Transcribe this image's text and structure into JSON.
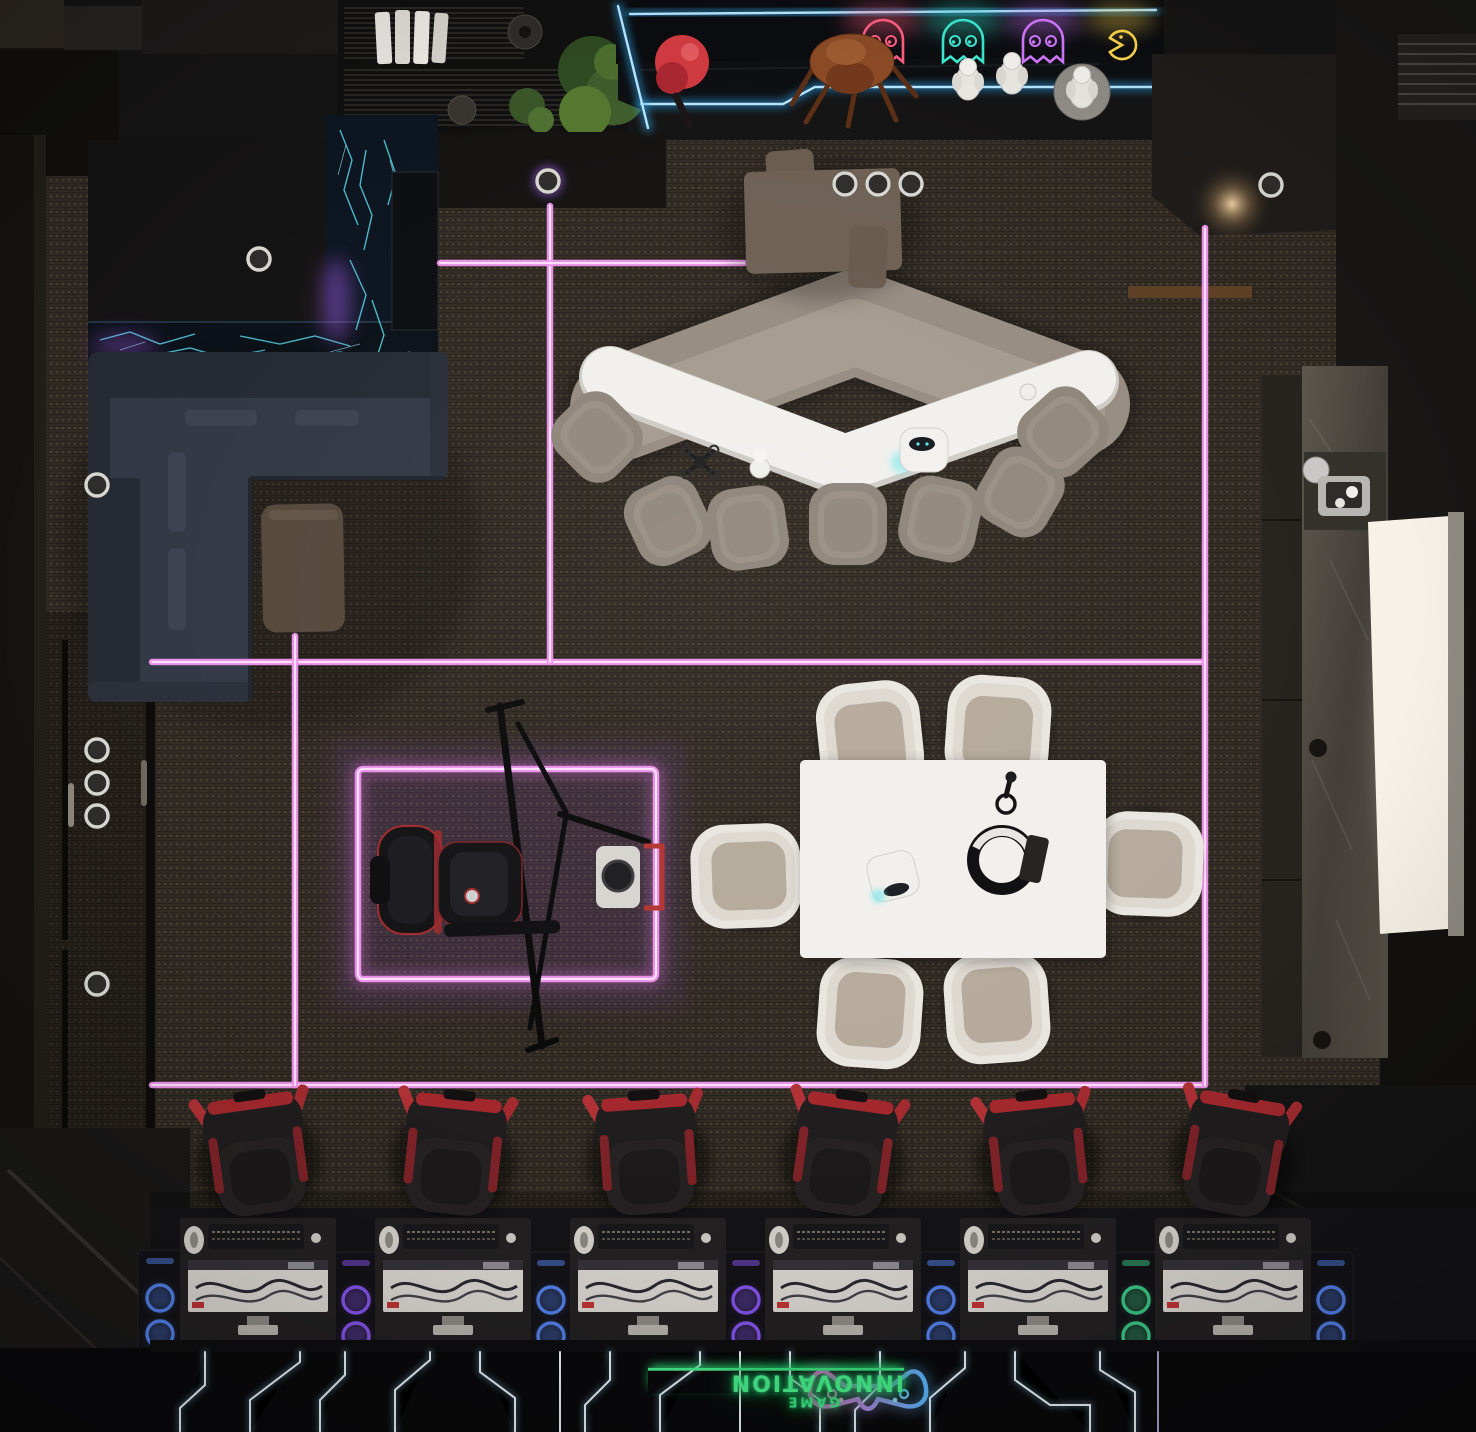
{
  "meta": {
    "scene_title": "Esports gaming lounge - top-down 3D render",
    "style": "dark cyberpunk interior, magenta neon floor grid, blue LED accents"
  },
  "neon_sign": {
    "line1": "GAME",
    "line2": "INNOVATION",
    "color": "#49f08d",
    "controller_icon_colors": [
      "#59b8ff",
      "#ff5fd0"
    ]
  },
  "palette": {
    "carpet": "#322b24",
    "floor_dark": "#0a0a0c",
    "neon_magenta": "#ef93ee",
    "led_blue": "#b5e4ff",
    "neon_green": "#49f08d",
    "crack_teal": "#55d6e8",
    "sofa_navy": "#333845",
    "lounge_taupe": "#968c82",
    "table_white": "#f2f0ed",
    "chair_cream": "#e9e5df",
    "gamer_red": "#b03136",
    "wood_brown": "#55493c",
    "stone_counter": "#57524a",
    "light_panel": "#f6f2e7"
  },
  "counts": {
    "gaming_stations": 6,
    "gaming_chairs": 6,
    "meeting_chairs": 6,
    "lounge_chairs": 7,
    "neon_ghosts": 3,
    "pacman": 1,
    "ceiling_lights": 11,
    "rgb_pc_towers": 7
  },
  "zones": [
    {
      "name": "arcade-display-wall",
      "items": [
        "neon-ghost-red",
        "neon-ghost-teal",
        "neon-ghost-purple",
        "neon-pacman-yellow",
        "red-mascot-figurine",
        "rust-robot-figurine",
        "astronaut-figurines",
        "blue-led-counter-edges"
      ]
    },
    {
      "name": "shelf-unit",
      "items": [
        "white-books",
        "dark-vases",
        "potted-plants",
        "wire-shelves"
      ]
    },
    {
      "name": "led-crack-wall",
      "items": [
        "teal-lightning-led-panel",
        "wall-screen",
        "purple-glow"
      ]
    },
    {
      "name": "corner-sofa-nook",
      "items": [
        "dark-l-shaped-sofa",
        "walnut-side-table"
      ]
    },
    {
      "name": "chevron-lounge",
      "items": [
        "taupe-chevron-sofa",
        "white-chevron-table",
        "lounge-chairs",
        "mini-drone",
        "white-figurine",
        "desk-robot",
        "cup"
      ]
    },
    {
      "name": "wood-standing-table",
      "items": [
        "attached-stools",
        "ceiling-downlights"
      ]
    },
    {
      "name": "meeting-area",
      "items": [
        "white-meeting-table",
        "cream-armchairs",
        "vr-headset",
        "vr-controller",
        "tablet",
        "desk-robot"
      ]
    },
    {
      "name": "racing-sim-zone",
      "items": [
        "racing-seat",
        "steering-wheel-rig",
        "triple-monitor-mount",
        "purple-neon-floor-border"
      ]
    },
    {
      "name": "pc-battlestations",
      "items": [
        "gaming-desks",
        "racing-game-monitors",
        "keyboards",
        "headsets",
        "gaming-chairs",
        "rgb-pc-towers"
      ]
    },
    {
      "name": "kitchenette-counter",
      "items": [
        "stone-counter",
        "coffee-machine",
        "cups",
        "backlit-light-panel",
        "sink-drains"
      ]
    },
    {
      "name": "corridor",
      "items": [
        "ceiling-downlights",
        "door-handles"
      ]
    },
    {
      "name": "floor-graphics",
      "items": [
        "magenta-neon-grid",
        "white-circuit-traces",
        "game-innovation-neon-sign",
        "neon-controller-icon"
      ]
    }
  ]
}
